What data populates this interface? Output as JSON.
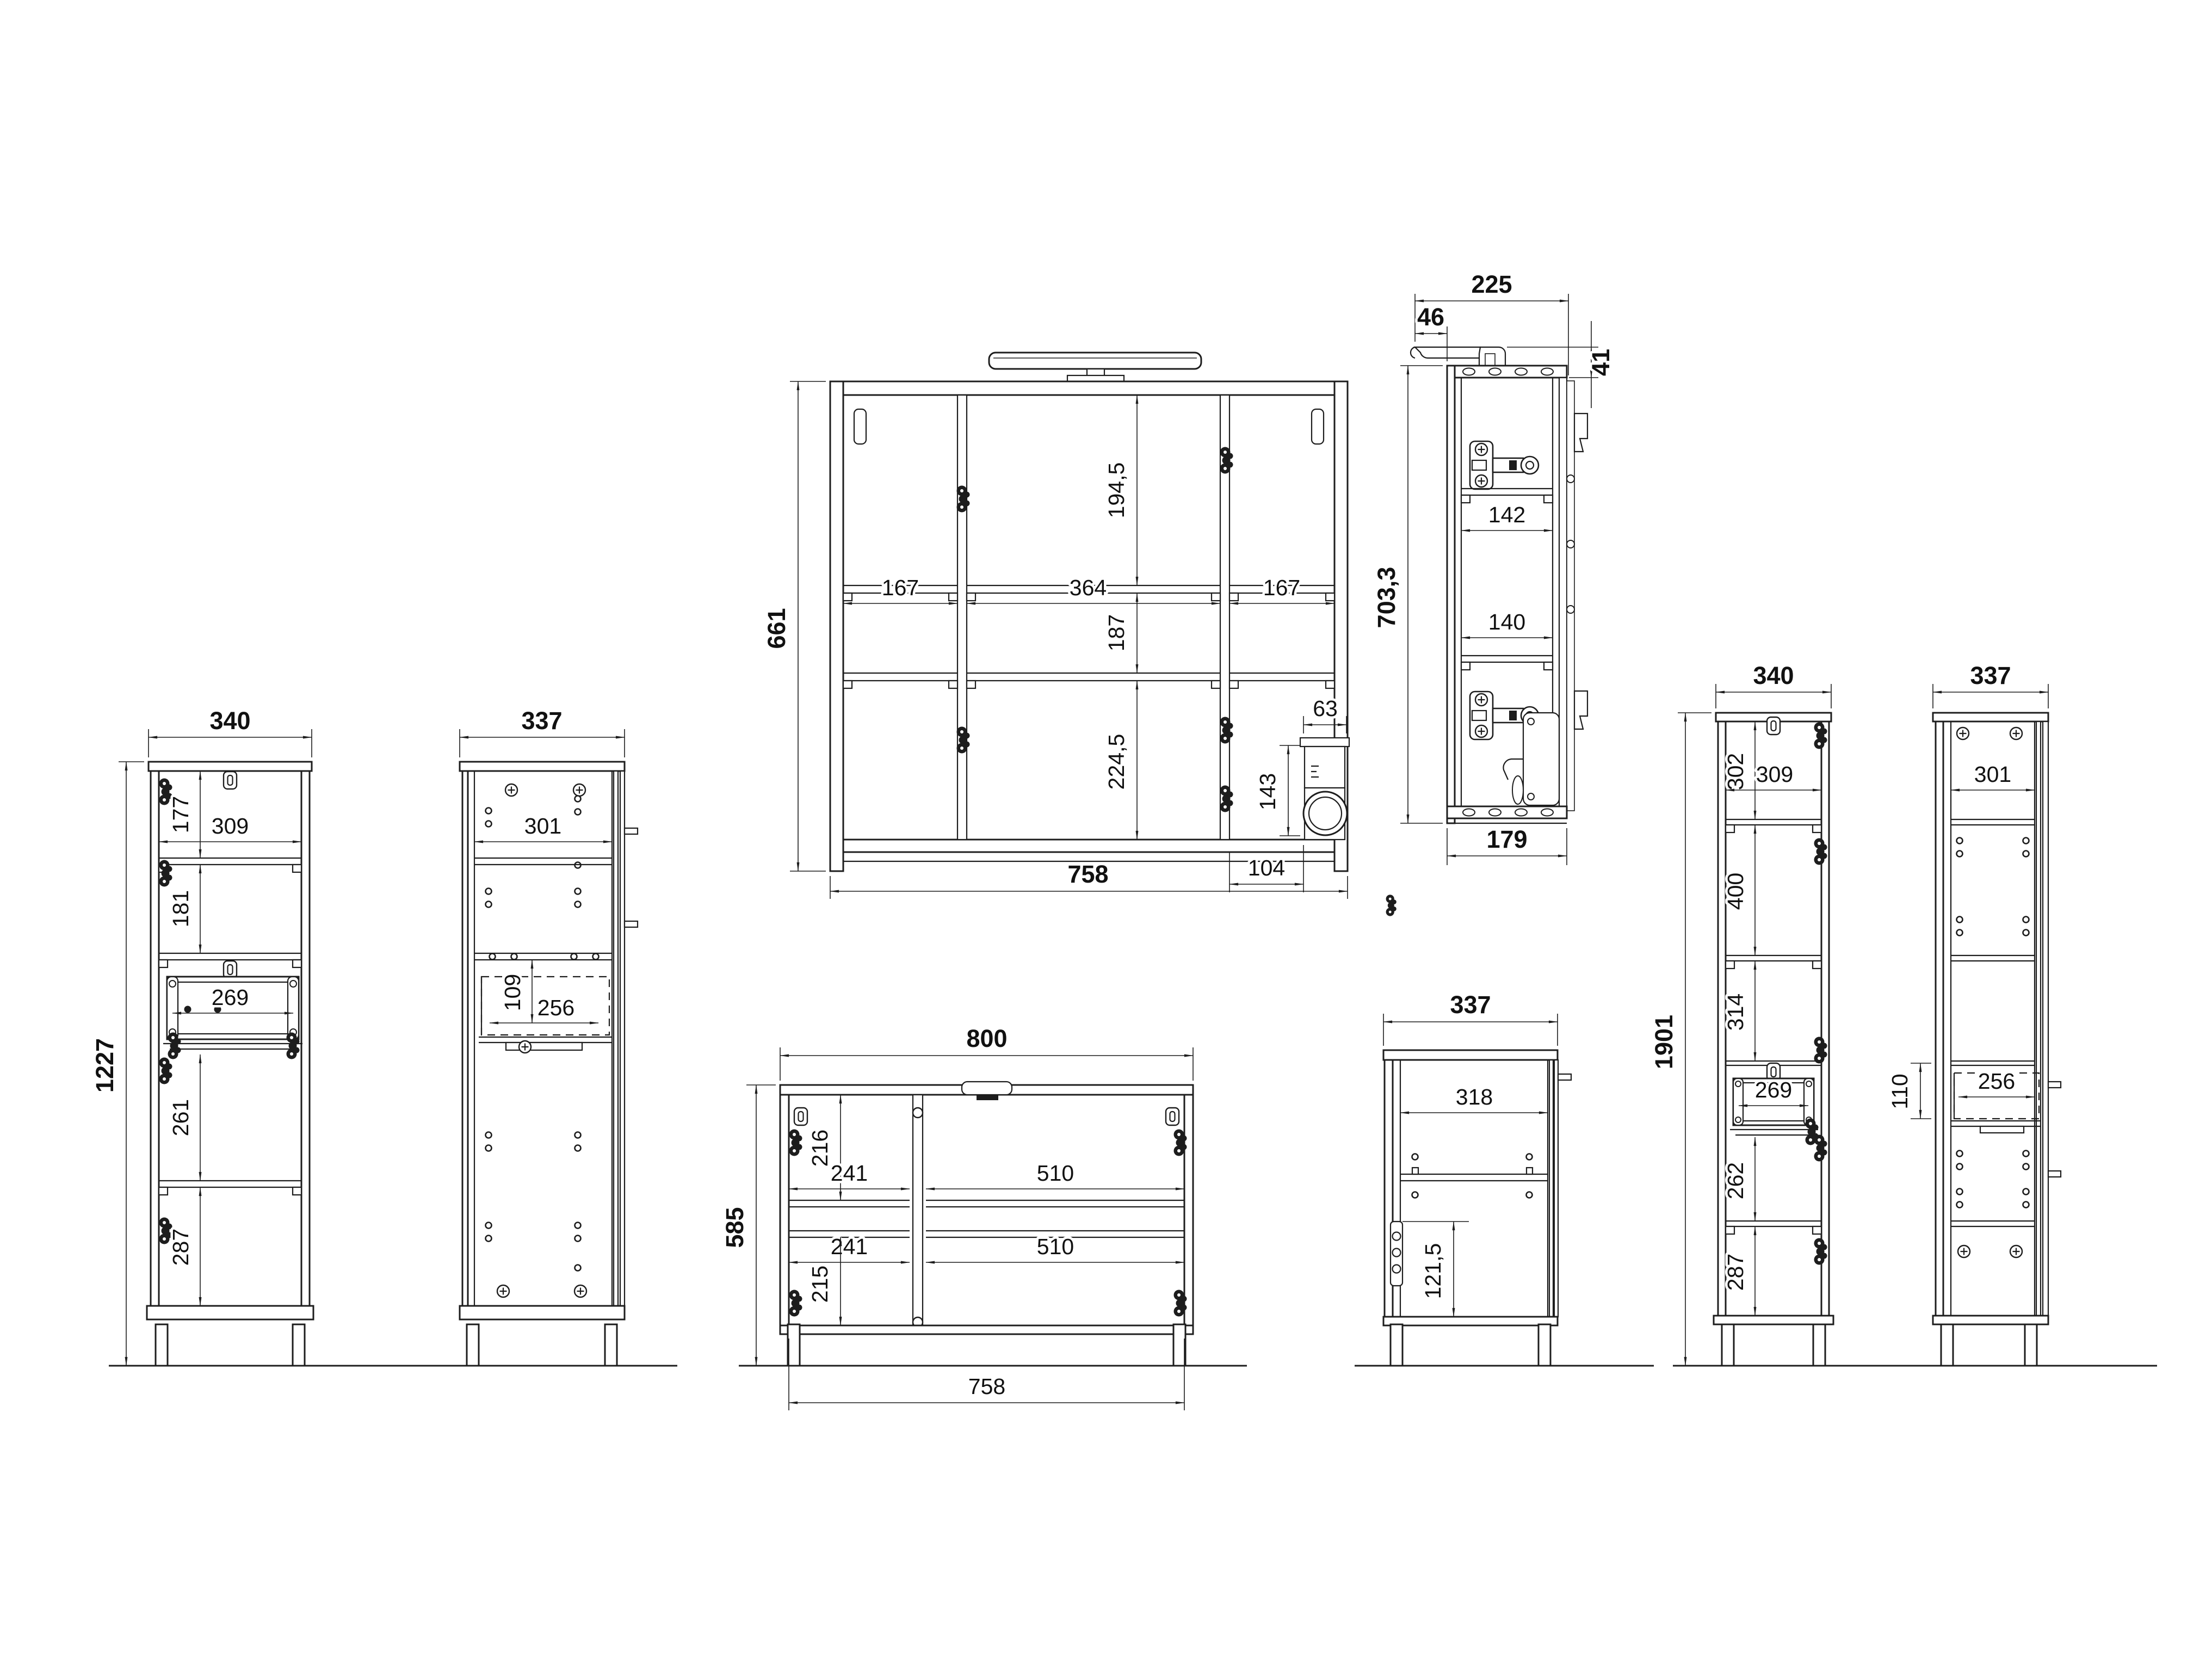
{
  "page": {
    "background": "#ffffff",
    "line_color": "#1d1d1d",
    "drawing_type": "furniture assembly dimension drawing"
  },
  "views": {
    "mirror_cabinet_front": {
      "labels": {
        "height": "661",
        "width": "758",
        "top_section": "194,5",
        "middle_section": "187",
        "left_compartment": "167",
        "middle_compartment": "364",
        "right_compartment": "167",
        "bottom_section": "224,5",
        "socket_width": "63",
        "socket_height": "143",
        "socket_offset": "104"
      }
    },
    "mirror_cabinet_side": {
      "labels": {
        "depth_total": "225",
        "lamp_offset": "46",
        "lamp_height": "41",
        "height": "703,3",
        "shelf_depth_upper": "142",
        "shelf_depth_lower": "140",
        "body_depth": "179"
      }
    },
    "tall_cabinet_left_front": {
      "labels": {
        "width": "340",
        "height": "1227",
        "top_section": "177",
        "inner_width": "309",
        "second_section": "181",
        "drawer_width": "269",
        "third_section": "261",
        "bottom_section": "287"
      }
    },
    "tall_cabinet_left_side": {
      "labels": {
        "width": "337",
        "inner_depth": "301",
        "drawer_height": "109",
        "drawer_depth": "256"
      }
    },
    "vanity_front": {
      "labels": {
        "width": "800",
        "height": "585",
        "top_section": "216",
        "left_shelf_upper": "241",
        "right_shelf_upper": "510",
        "left_shelf_lower": "241",
        "right_shelf_lower": "510",
        "bottom_section": "215",
        "inner_width": "758"
      }
    },
    "vanity_side": {
      "labels": {
        "width": "337",
        "inner_depth": "318",
        "bracket_height": "121,5"
      }
    },
    "tall_cabinet_right_front": {
      "labels": {
        "width": "340",
        "height": "1901",
        "top_section": "302",
        "inner_width": "309",
        "second_section": "400",
        "third_section": "314",
        "drawer_width": "269",
        "fourth_section": "262",
        "bottom_section": "287"
      }
    },
    "tall_cabinet_right_side": {
      "labels": {
        "width": "337",
        "inner_depth": "301",
        "drawer_height": "110",
        "drawer_depth": "256"
      }
    }
  }
}
